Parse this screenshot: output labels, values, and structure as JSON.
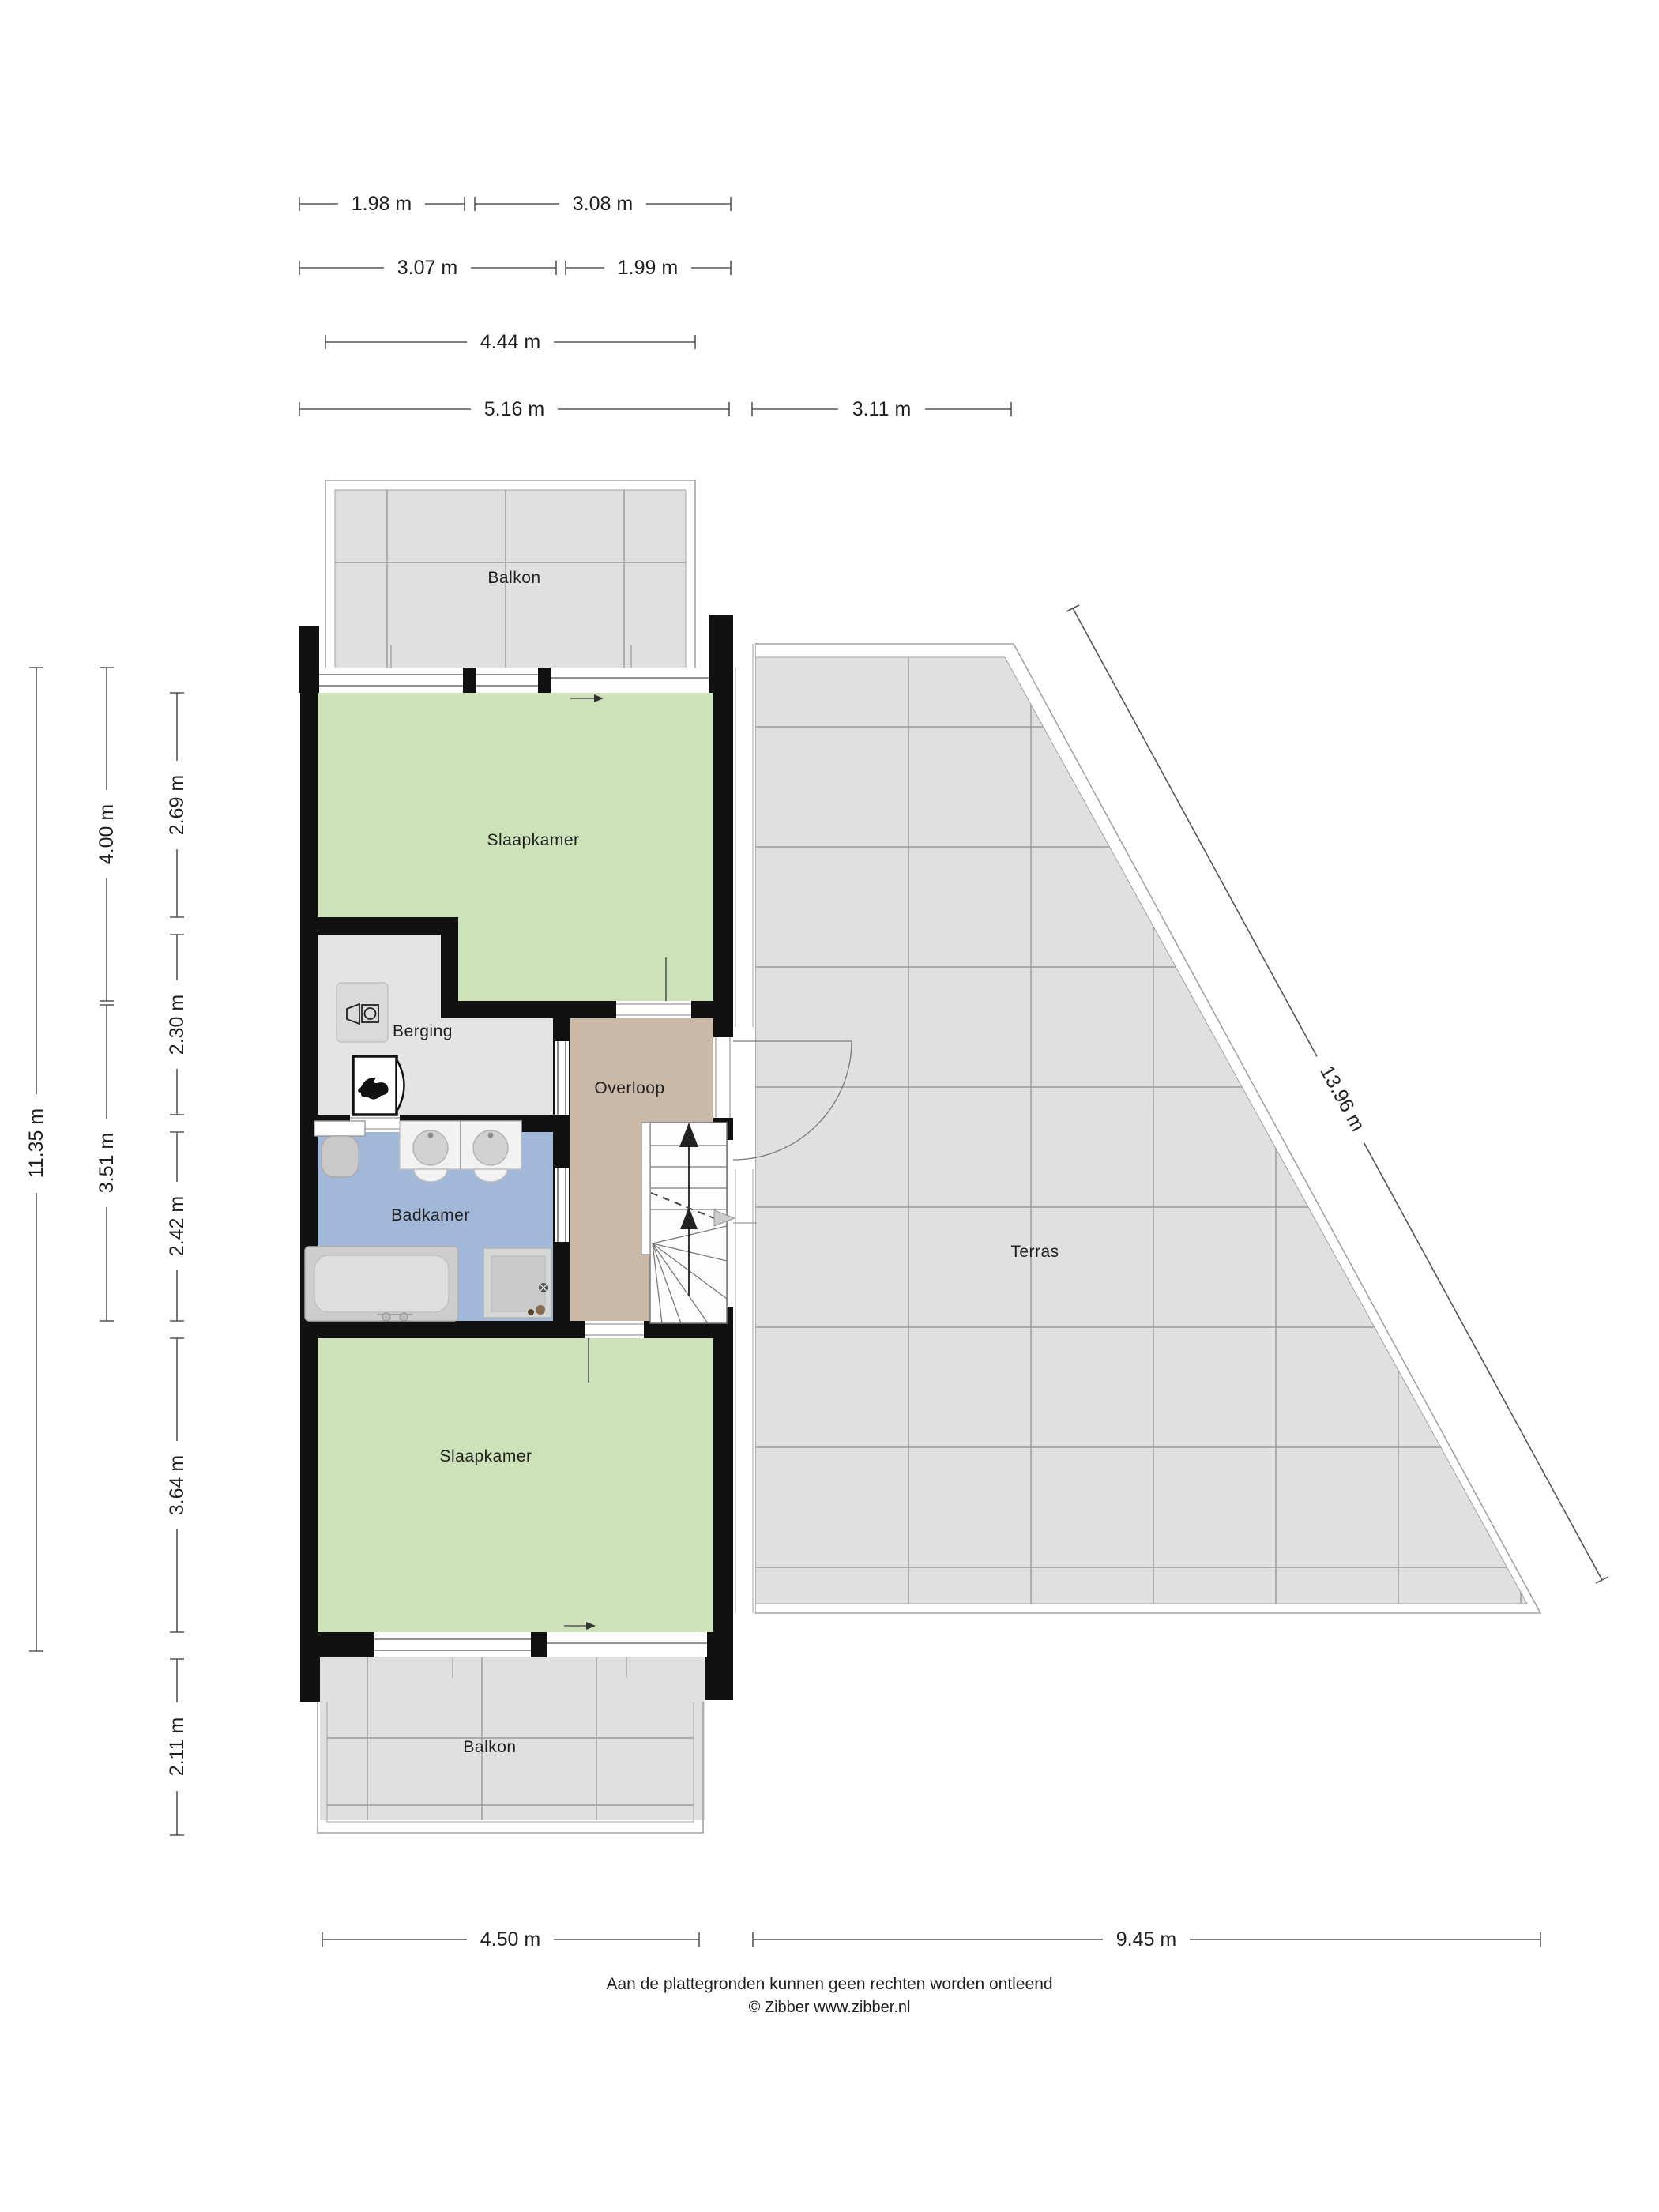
{
  "rooms": {
    "balkon_top": "Balkon",
    "slaapkamer_top": "Slaapkamer",
    "berging": "Berging",
    "overloop": "Overloop",
    "badkamer": "Badkamer",
    "slaapkamer_bottom": "Slaapkamer",
    "balkon_bottom": "Balkon",
    "terras": "Terras"
  },
  "dims": {
    "top1a": "1.98 m",
    "top1b": "3.08 m",
    "top2a": "3.07 m",
    "top2b": "1.99 m",
    "top3": "4.44 m",
    "top4a": "5.16 m",
    "top4b": "3.11 m",
    "left1": "11.35 m",
    "left2a": "4.00 m",
    "left2b": "3.51 m",
    "left3a": "2.69 m",
    "left3b": "2.30 m",
    "left3c": "2.42 m",
    "left3d": "3.64 m",
    "left3e": "2.11 m",
    "bottom1": "4.50 m",
    "bottom2": "9.45 m",
    "diag": "13.96 m"
  },
  "footer": {
    "line1": "Aan de plattegronden kunnen geen rechten worden ontleend",
    "line2": "© Zibber www.zibber.nl"
  },
  "icons": {
    "boiler": "flame-icon",
    "washer": "washing-machine-icon",
    "stairs": "arrow-up-icon",
    "doors": "door-swing-icon"
  },
  "colors": {
    "wall": "#111111",
    "green": "#cde2b8",
    "blue": "#a2b8d8",
    "tan": "#c9b9a6",
    "grayroom": "#e4e4e4",
    "grayout": "#e0e0e0",
    "grid": "#9a9a9a",
    "rail": "#a3a3a3",
    "dim": "#555555",
    "text": "#1f1f1f"
  }
}
